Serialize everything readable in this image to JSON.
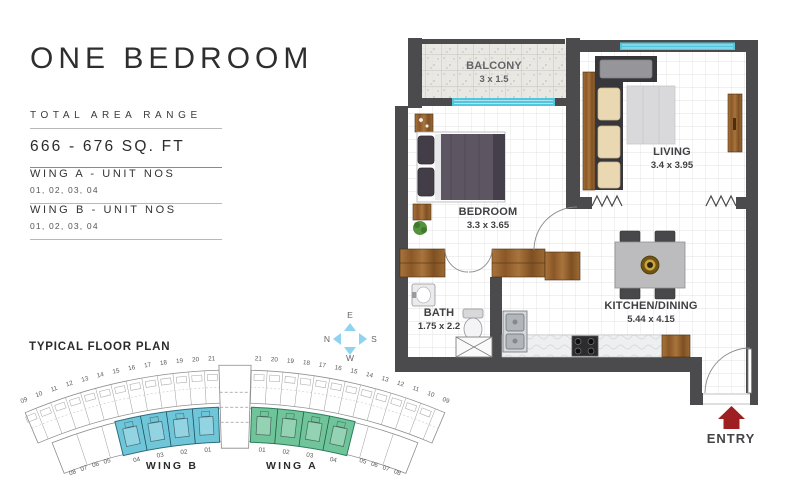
{
  "left_panel": {
    "title": "ONE BEDROOM",
    "area_label": "TOTAL AREA RANGE",
    "area_value": "666 - 676 SQ. FT",
    "wing_a_label": "WING A - UNIT NOS",
    "wing_a_units": "01, 02, 03, 04",
    "wing_b_label": "WING B - UNIT NOS",
    "wing_b_units": "01, 02, 03, 04"
  },
  "typical_plan": {
    "title": "TYPICAL FLOOR PLAN",
    "wing_b_label": "WING B",
    "wing_a_label": "WING A",
    "upper_left_numbers": [
      "09",
      "10",
      "11",
      "12",
      "13",
      "14",
      "15",
      "16",
      "17",
      "18",
      "19",
      "20",
      "21"
    ],
    "upper_right_numbers": [
      "21",
      "20",
      "19",
      "18",
      "17",
      "16",
      "15",
      "14",
      "13",
      "12",
      "11",
      "10",
      "09"
    ],
    "wing_b_unit_numbers": [
      "04",
      "03",
      "02",
      "01"
    ],
    "wing_a_unit_numbers": [
      "01",
      "02",
      "03",
      "04"
    ],
    "left_cluster_numbers": [
      "08",
      "07",
      "06",
      "05"
    ],
    "right_cluster_numbers": [
      "05",
      "06",
      "07",
      "08"
    ],
    "wing_b_color": "#6ec6d8",
    "wing_a_color": "#6fc49a"
  },
  "compass": {
    "north": "N",
    "south": "S",
    "east": "E",
    "west": "W",
    "arrow_color": "#8ed4f0"
  },
  "floor_plan": {
    "rooms": [
      {
        "name": "BALCONY",
        "dims": "3 x 1.5"
      },
      {
        "name": "LIVING",
        "dims": "3.4 x 3.95"
      },
      {
        "name": "BEDROOM",
        "dims": "3.3 x 3.65"
      },
      {
        "name": "BATH",
        "dims": "1.75 x 2.2"
      },
      {
        "name": "KITCHEN/DINING",
        "dims": "5.44 x 4.15"
      }
    ],
    "entry_label": "ENTRY",
    "colors": {
      "wall": "#4b4b4d",
      "wood": "#9c6a33",
      "window": "#52c6dd",
      "entry": "#9e1f22"
    }
  }
}
